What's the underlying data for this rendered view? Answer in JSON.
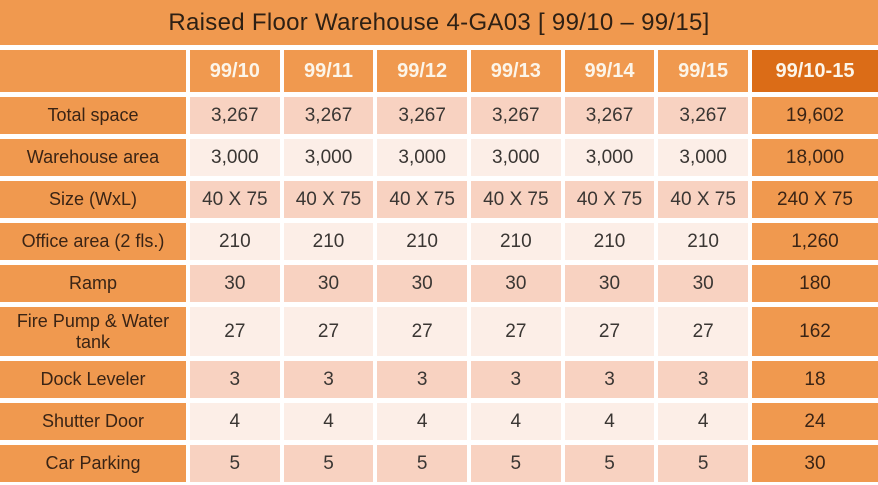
{
  "title": "Raised Floor Warehouse 4-GA03  [ 99/10 – 99/15]",
  "table": {
    "columns": [
      "",
      "99/10",
      "99/11",
      "99/12",
      "99/13",
      "99/14",
      "99/15",
      "99/10-15"
    ],
    "rows": [
      {
        "label": "Total space",
        "values": [
          "3,267",
          "3,267",
          "3,267",
          "3,267",
          "3,267",
          "3,267"
        ],
        "total": "19,602"
      },
      {
        "label": "Warehouse area",
        "values": [
          "3,000",
          "3,000",
          "3,000",
          "3,000",
          "3,000",
          "3,000"
        ],
        "total": "18,000"
      },
      {
        "label": "Size (WxL)",
        "values": [
          "40 X 75",
          "40 X 75",
          "40 X 75",
          "40 X 75",
          "40 X 75",
          "40 X 75"
        ],
        "total": "240 X 75"
      },
      {
        "label": "Office area (2 fls.)",
        "values": [
          "210",
          "210",
          "210",
          "210",
          "210",
          "210"
        ],
        "total": "1,260"
      },
      {
        "label": "Ramp",
        "values": [
          "30",
          "30",
          "30",
          "30",
          "30",
          "30"
        ],
        "total": "180"
      },
      {
        "label": "Fire Pump & Water tank",
        "values": [
          "27",
          "27",
          "27",
          "27",
          "27",
          "27"
        ],
        "total": "162"
      },
      {
        "label": "Dock Leveler",
        "values": [
          "3",
          "3",
          "3",
          "3",
          "3",
          "3"
        ],
        "total": "18"
      },
      {
        "label": "Shutter Door",
        "values": [
          "4",
          "4",
          "4",
          "4",
          "4",
          "4"
        ],
        "total": "24"
      },
      {
        "label": "Car Parking",
        "values": [
          "5",
          "5",
          "5",
          "5",
          "5",
          "5"
        ],
        "total": "30"
      }
    ]
  },
  "colors": {
    "orange": "#F0994F",
    "orange_dark": "#DB6C17",
    "row_pink": "#F8D2C1",
    "row_light": "#FCEEE7",
    "gap_white": "#FFFFFF",
    "title_text": "#2E2014",
    "label_text": "#3A2415",
    "cell_text": "#3A3633",
    "header_text": "#FCF5E9"
  }
}
